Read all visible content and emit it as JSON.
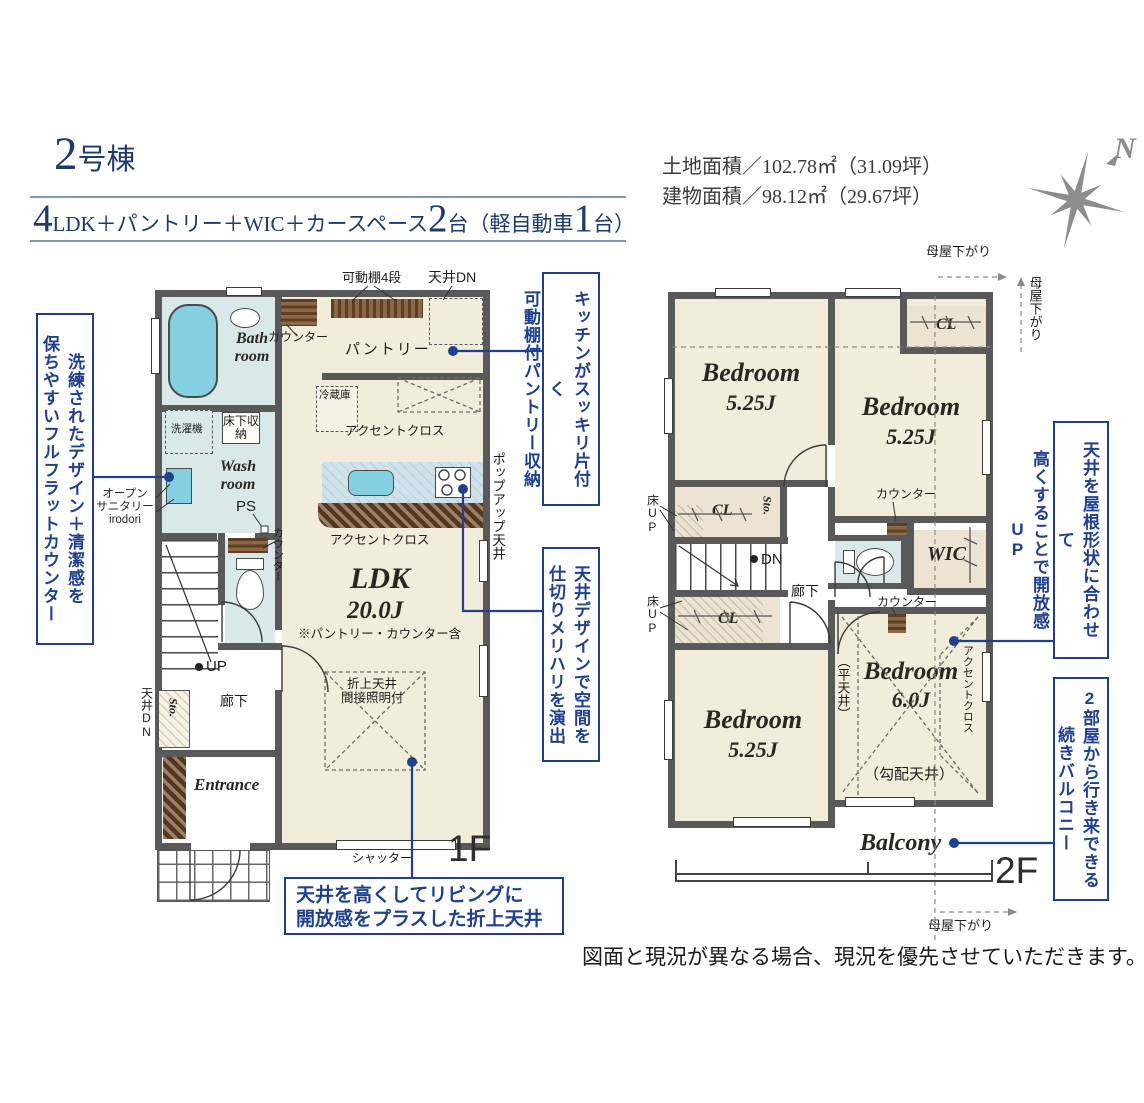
{
  "colors": {
    "accent_blue": "#20408f",
    "title_navy": "#1d3a6d",
    "wall_gray": "#595959",
    "floor_cream": "#f2ecda",
    "water_blue": "#d9e8e9",
    "fixture_blue": "#84cfe0",
    "counter_brown": "#6f4a2b",
    "compass_gray": "#8d8d8d"
  },
  "header": {
    "building": {
      "number": "2",
      "suffix": "号棟"
    },
    "spec": {
      "n4": "4",
      "t1": "LDK＋パントリー＋WIC＋カースペース",
      "n2": "2",
      "t2": "台",
      "t3": "（軽自動車",
      "n1": "1",
      "t4": "台）"
    }
  },
  "site": {
    "land": "土地面積／102.78㎡（31.09坪）",
    "building": "建物面積／98.12㎡（29.67坪）"
  },
  "compass": {
    "north": "N"
  },
  "callouts": {
    "counter": {
      "l1": "洗練されたデザイン＋清潔感を",
      "l2": "保ちやすいフルフラットカウンター"
    },
    "pantry": {
      "l1": "キッチンがスッキリ片付く",
      "l2": "可動棚付パントリー収納"
    },
    "ceiling_zone": {
      "l1": "天井デザインで空間を",
      "l2": "仕切りメリハリを演出"
    },
    "coffered": {
      "l1": "天井を高くしてリビングに",
      "l2": "開放感をプラスした折上天井"
    },
    "roof": {
      "l1": "天井を屋根形状に合わせて",
      "l2": "高くすることで開放感UP"
    },
    "balcony": {
      "l1": "2部屋から行き来できる",
      "l2": "続きバルコニー"
    }
  },
  "f1": {
    "floor": "1F",
    "shelf": "可動棚4段",
    "ceiling_dn_top": "天井DN",
    "counter_top": "カウンター",
    "pantry": "パントリー",
    "fridge": "冷蔵庫",
    "accent_top": "アクセントクロス",
    "underfloor_k": "床下収納",
    "popup": "ポップアップ天井",
    "accent_bottom": "アクセントクロス",
    "bath": "Bath room",
    "washer": "洗濯機",
    "underfloor_w": "床下収納",
    "wash": "Wash room",
    "ps": "PS",
    "open_sanitary": "オープン\nサニタリー\nirodori",
    "counter_left": "カウンター",
    "ldk": "LDK",
    "ldk_size": "20.0J",
    "ldk_note": "※パントリー・カウンター含",
    "coffered1": "折上天井",
    "coffered2": "間接照明付",
    "up": "UP",
    "hall": "廊下",
    "sto": "Sto.",
    "ceiling_dn_left": "天井DN",
    "entrance": "Entrance",
    "shutter": "シャッター"
  },
  "f2": {
    "floor": "2F",
    "moya_top": "母屋下がり",
    "moya_right": "母屋下がり",
    "moya_bottom": "母屋下がり",
    "bed_tl": {
      "name": "Bedroom",
      "size": "5.25J"
    },
    "bed_tr": {
      "name": "Bedroom",
      "size": "5.25J"
    },
    "bed_bl": {
      "name": "Bedroom",
      "size": "5.25J"
    },
    "bed_br": {
      "name": "Bedroom",
      "size": "6.0J"
    },
    "cl_tr": "CL",
    "cl_a": "CL",
    "cl_b": "CL",
    "sto": "Sto.",
    "floor_up1": "床UP",
    "floor_up2": "床UP",
    "dn": "DN",
    "hall": "廊下",
    "wic": "WIC",
    "counter1": "カウンター",
    "counter2": "カウンター",
    "flat": "（平天井）",
    "slope": "（勾配天井）",
    "accent": "アクセントクロス",
    "balcony": "Balcony"
  },
  "disclaimer": "図面と現況が異なる場合、現況を優先させていただきます。"
}
